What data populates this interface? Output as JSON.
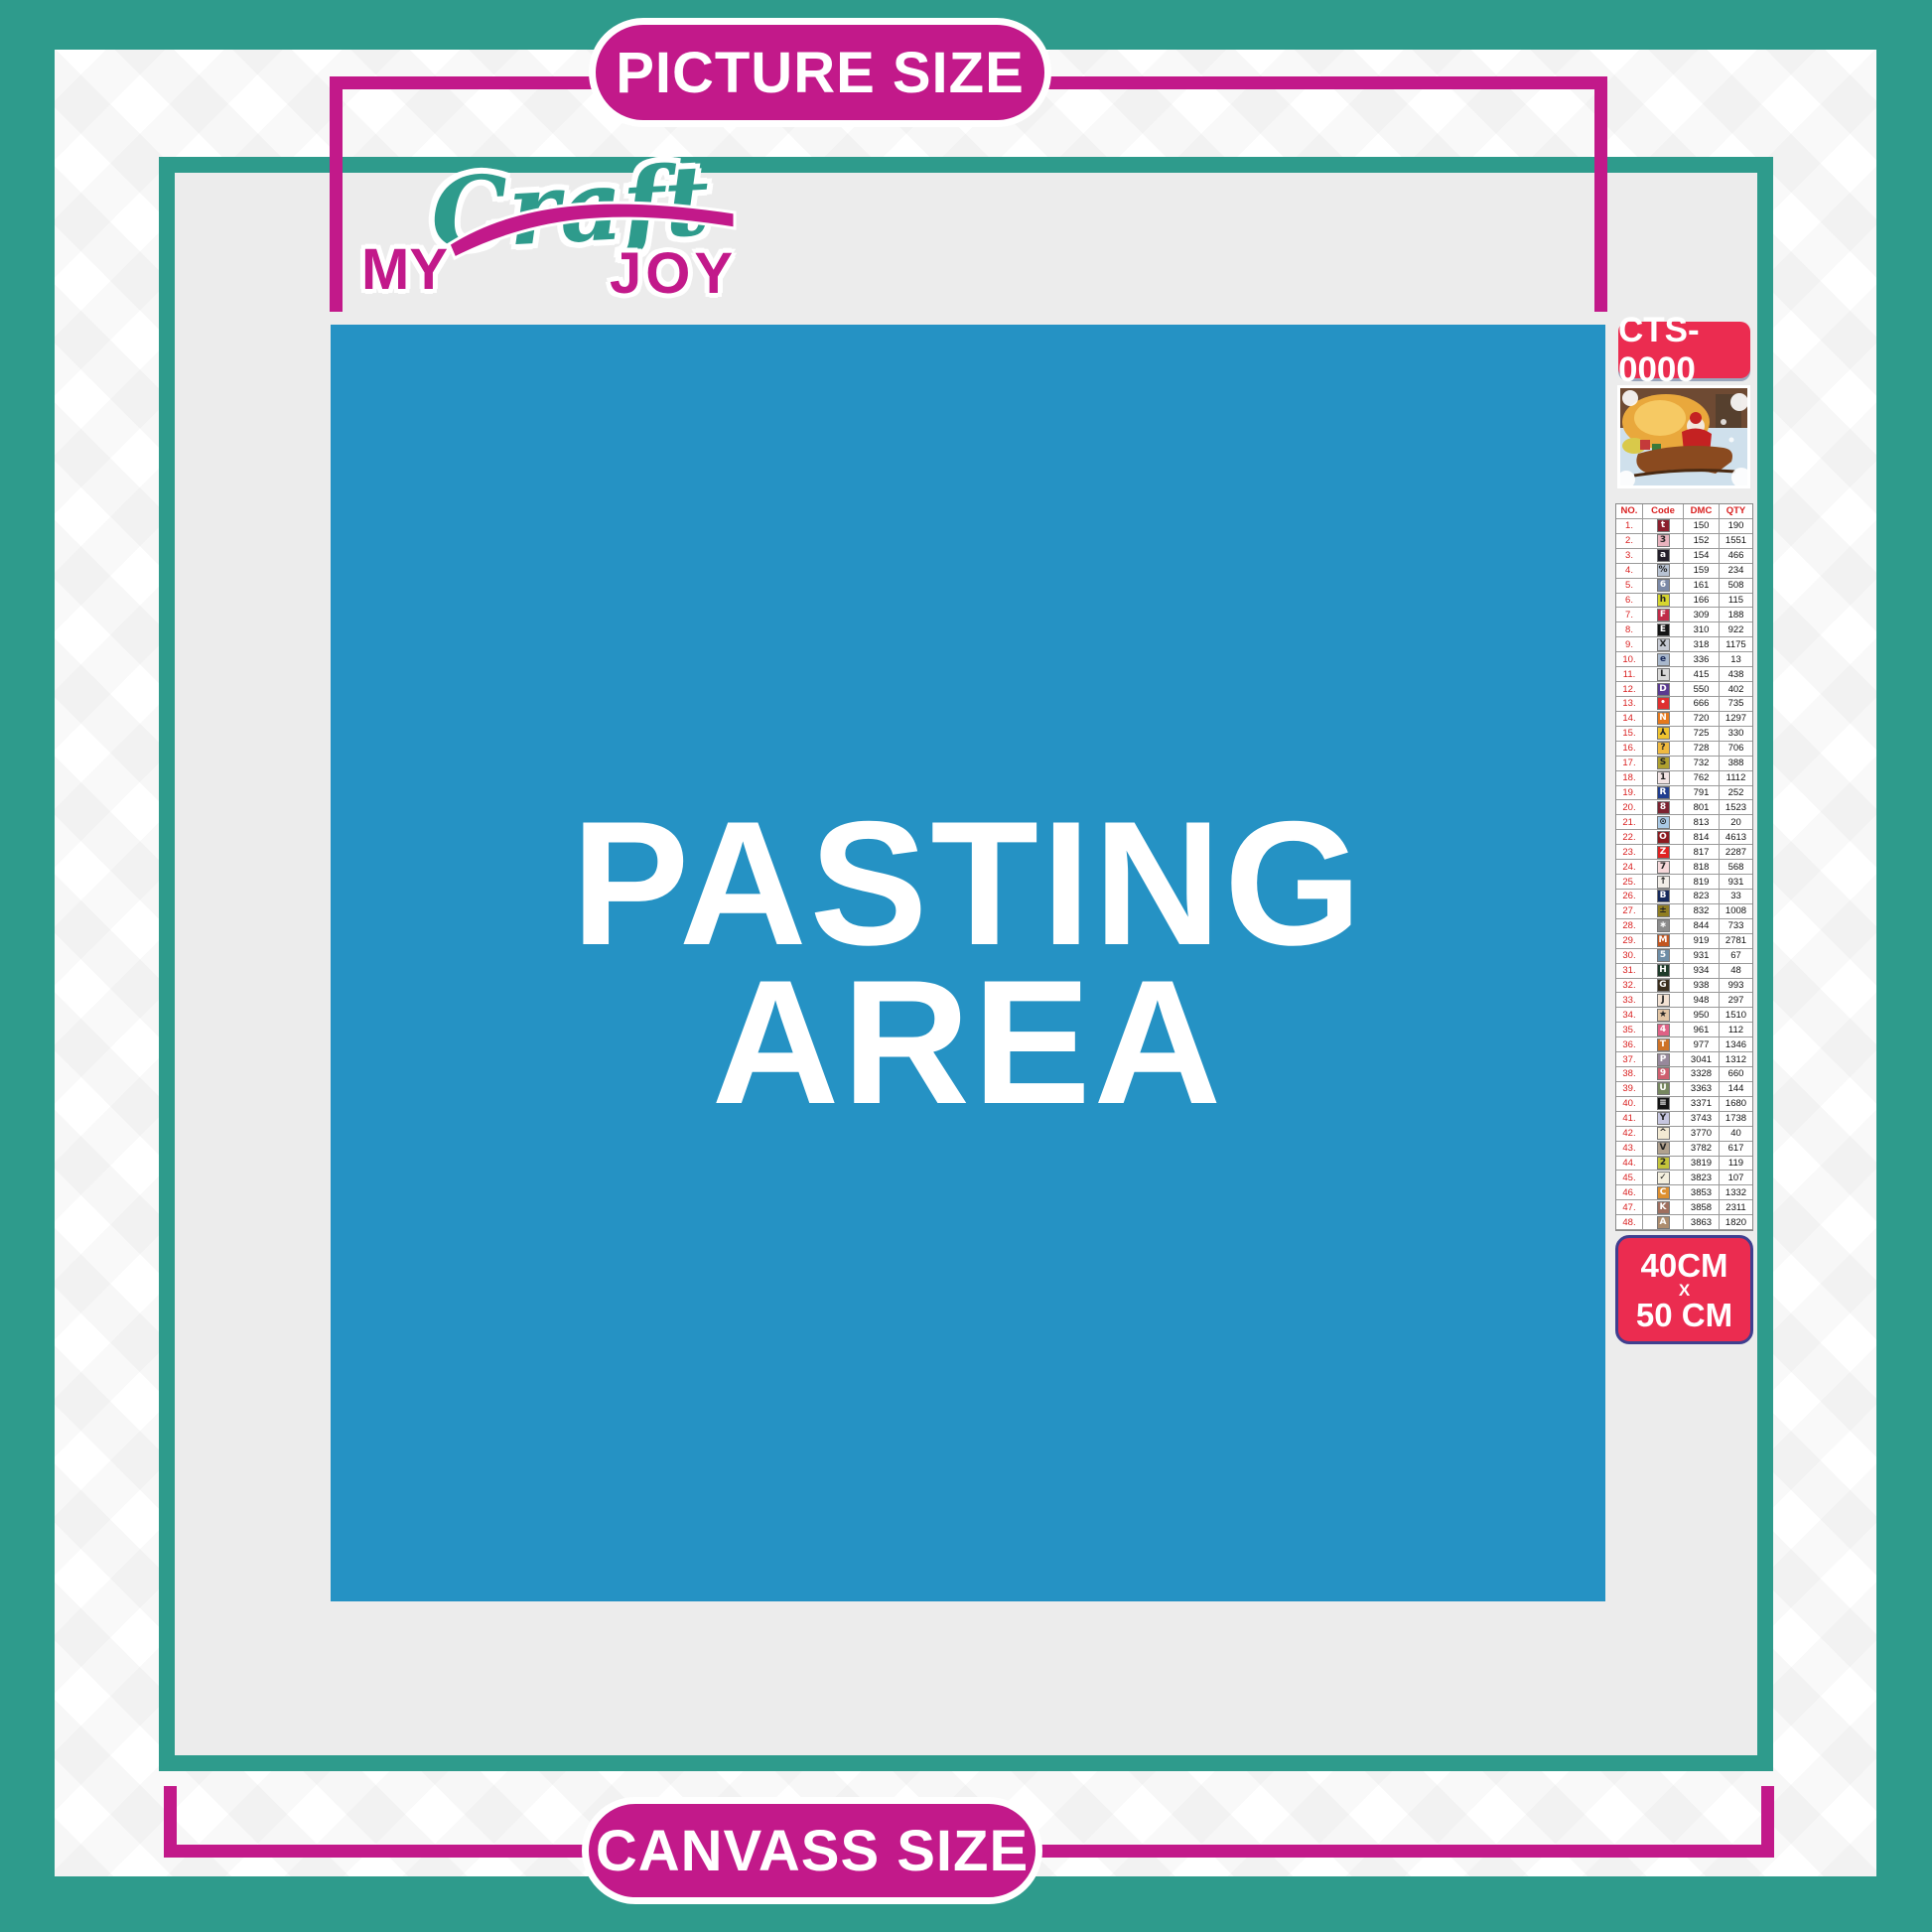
{
  "banners": {
    "top": "PICTURE SIZE",
    "bottom": "CANVASS SIZE"
  },
  "logo": {
    "part1": "MY",
    "part2": "Craft",
    "part3": "JOY"
  },
  "pasting_area": {
    "line1": "PASTING",
    "line2": "AREA"
  },
  "product": {
    "code": "CTS-0000",
    "size_line1": "40CM",
    "size_line2": "X",
    "size_line3": "50 CM",
    "preview": "santa-claus-sleigh-christmas-painting-thumbnail"
  },
  "colors": {
    "teal": "#2E9B8C",
    "magenta": "#C2198A",
    "blue_pasting": "#2592C4",
    "badge_red": "#EB2C50",
    "badge_border_blue": "#3F3F8F",
    "inner_gray": "#ECECEC",
    "table_red": "#D91F1F"
  },
  "color_chart": {
    "headers": [
      "NO.",
      "Code",
      "DMC",
      "QTY"
    ],
    "rows": [
      {
        "no": "1.",
        "symbol": "t",
        "symbol_bg": "#8B1E2D",
        "symbol_fg": "#FFFFFF",
        "dmc": "150",
        "qty": "190"
      },
      {
        "no": "2.",
        "symbol": "3",
        "symbol_bg": "#E9B3BE",
        "symbol_fg": "#222222",
        "dmc": "152",
        "qty": "1551"
      },
      {
        "no": "3.",
        "symbol": "a",
        "symbol_bg": "#241F2A",
        "symbol_fg": "#FFFFFF",
        "dmc": "154",
        "qty": "466"
      },
      {
        "no": "4.",
        "symbol": "%",
        "symbol_bg": "#B7C2D2",
        "symbol_fg": "#222222",
        "dmc": "159",
        "qty": "234"
      },
      {
        "no": "5.",
        "symbol": "6",
        "symbol_bg": "#7B89A6",
        "symbol_fg": "#FFFFFF",
        "dmc": "161",
        "qty": "508"
      },
      {
        "no": "6.",
        "symbol": "h",
        "symbol_bg": "#D6D52F",
        "symbol_fg": "#222222",
        "dmc": "166",
        "qty": "115"
      },
      {
        "no": "7.",
        "symbol": "F",
        "symbol_bg": "#C02A48",
        "symbol_fg": "#FFFFFF",
        "dmc": "309",
        "qty": "188"
      },
      {
        "no": "8.",
        "symbol": "E",
        "symbol_bg": "#141414",
        "symbol_fg": "#FFFFFF",
        "dmc": "310",
        "qty": "922"
      },
      {
        "no": "9.",
        "symbol": "X",
        "symbol_bg": "#C6CAD3",
        "symbol_fg": "#222222",
        "dmc": "318",
        "qty": "1175"
      },
      {
        "no": "10.",
        "symbol": "e",
        "symbol_bg": "#A9B8CC",
        "symbol_fg": "#1A2A5A",
        "dmc": "336",
        "qty": "13"
      },
      {
        "no": "11.",
        "symbol": "L",
        "symbol_bg": "#D8D8D8",
        "symbol_fg": "#222222",
        "dmc": "415",
        "qty": "438"
      },
      {
        "no": "12.",
        "symbol": "D",
        "symbol_bg": "#5A3A90",
        "symbol_fg": "#FFFFFF",
        "dmc": "550",
        "qty": "402"
      },
      {
        "no": "13.",
        "symbol": "•",
        "symbol_bg": "#DF2F2F",
        "symbol_fg": "#FFFFFF",
        "dmc": "666",
        "qty": "735"
      },
      {
        "no": "14.",
        "symbol": "N",
        "symbol_bg": "#E5791D",
        "symbol_fg": "#FFFFFF",
        "dmc": "720",
        "qty": "1297"
      },
      {
        "no": "15.",
        "symbol": "⅄",
        "symbol_bg": "#EFC32F",
        "symbol_fg": "#222222",
        "dmc": "725",
        "qty": "330"
      },
      {
        "no": "16.",
        "symbol": "?",
        "symbol_bg": "#EFB93F",
        "symbol_fg": "#222222",
        "dmc": "728",
        "qty": "706"
      },
      {
        "no": "17.",
        "symbol": "S",
        "symbol_bg": "#AFA02F",
        "symbol_fg": "#222222",
        "dmc": "732",
        "qty": "388"
      },
      {
        "no": "18.",
        "symbol": "1",
        "symbol_bg": "#F2E4E4",
        "symbol_fg": "#222222",
        "dmc": "762",
        "qty": "1112"
      },
      {
        "no": "19.",
        "symbol": "R",
        "symbol_bg": "#1F3D8F",
        "symbol_fg": "#FFFFFF",
        "dmc": "791",
        "qty": "252"
      },
      {
        "no": "20.",
        "symbol": "8",
        "symbol_bg": "#7C2230",
        "symbol_fg": "#FFFFFF",
        "dmc": "801",
        "qty": "1523"
      },
      {
        "no": "21.",
        "symbol": "⊙",
        "symbol_bg": "#A9C9E5",
        "symbol_fg": "#222222",
        "dmc": "813",
        "qty": "20"
      },
      {
        "no": "22.",
        "symbol": "O",
        "symbol_bg": "#8B1A1F",
        "symbol_fg": "#FFFFFF",
        "dmc": "814",
        "qty": "4613"
      },
      {
        "no": "23.",
        "symbol": "Z",
        "symbol_bg": "#DF2222",
        "symbol_fg": "#FFFFFF",
        "dmc": "817",
        "qty": "2287"
      },
      {
        "no": "24.",
        "symbol": "7",
        "symbol_bg": "#F6D8DA",
        "symbol_fg": "#222222",
        "dmc": "818",
        "qty": "568"
      },
      {
        "no": "25.",
        "symbol": "↑",
        "symbol_bg": "#F2EEE8",
        "symbol_fg": "#222222",
        "dmc": "819",
        "qty": "931"
      },
      {
        "no": "26.",
        "symbol": "B",
        "symbol_bg": "#172A5C",
        "symbol_fg": "#FFFFFF",
        "dmc": "823",
        "qty": "33"
      },
      {
        "no": "27.",
        "symbol": "±",
        "symbol_bg": "#8F7D22",
        "symbol_fg": "#222222",
        "dmc": "832",
        "qty": "1008"
      },
      {
        "no": "28.",
        "symbol": "∗",
        "symbol_bg": "#8C8C8C",
        "symbol_fg": "#FFFFFF",
        "dmc": "844",
        "qty": "733"
      },
      {
        "no": "29.",
        "symbol": "M",
        "symbol_bg": "#C2551F",
        "symbol_fg": "#FFFFFF",
        "dmc": "919",
        "qty": "2781"
      },
      {
        "no": "30.",
        "symbol": "5",
        "symbol_bg": "#6E8DA6",
        "symbol_fg": "#FFFFFF",
        "dmc": "931",
        "qty": "67"
      },
      {
        "no": "31.",
        "symbol": "H",
        "symbol_bg": "#1E3B2A",
        "symbol_fg": "#FFFFFF",
        "dmc": "934",
        "qty": "48"
      },
      {
        "no": "32.",
        "symbol": "G",
        "symbol_bg": "#3A2E1E",
        "symbol_fg": "#FFFFFF",
        "dmc": "938",
        "qty": "993"
      },
      {
        "no": "33.",
        "symbol": "J",
        "symbol_bg": "#F3E2D3",
        "symbol_fg": "#222222",
        "dmc": "948",
        "qty": "297"
      },
      {
        "no": "34.",
        "symbol": "★",
        "symbol_bg": "#E2C5A4",
        "symbol_fg": "#222222",
        "dmc": "950",
        "qty": "1510"
      },
      {
        "no": "35.",
        "symbol": "4",
        "symbol_bg": "#DE6185",
        "symbol_fg": "#FFFFFF",
        "dmc": "961",
        "qty": "112"
      },
      {
        "no": "36.",
        "symbol": "T",
        "symbol_bg": "#CE7227",
        "symbol_fg": "#FFFFFF",
        "dmc": "977",
        "qty": "1346"
      },
      {
        "no": "37.",
        "symbol": "P",
        "symbol_bg": "#97889B",
        "symbol_fg": "#FFFFFF",
        "dmc": "3041",
        "qty": "1312"
      },
      {
        "no": "38.",
        "symbol": "9",
        "symbol_bg": "#CE5F6F",
        "symbol_fg": "#FFFFFF",
        "dmc": "3328",
        "qty": "660"
      },
      {
        "no": "39.",
        "symbol": "U",
        "symbol_bg": "#76875F",
        "symbol_fg": "#FFFFFF",
        "dmc": "3363",
        "qty": "144"
      },
      {
        "no": "40.",
        "symbol": "≡",
        "symbol_bg": "#141414",
        "symbol_fg": "#FFFFFF",
        "dmc": "3371",
        "qty": "1680"
      },
      {
        "no": "41.",
        "symbol": "Y",
        "symbol_bg": "#C6C6DF",
        "symbol_fg": "#222222",
        "dmc": "3743",
        "qty": "1738"
      },
      {
        "no": "42.",
        "symbol": "^",
        "symbol_bg": "#F3EAD3",
        "symbol_fg": "#222222",
        "dmc": "3770",
        "qty": "40"
      },
      {
        "no": "43.",
        "symbol": "V",
        "symbol_bg": "#B0A18E",
        "symbol_fg": "#222222",
        "dmc": "3782",
        "qty": "617"
      },
      {
        "no": "44.",
        "symbol": "2",
        "symbol_bg": "#C4C43B",
        "symbol_fg": "#222222",
        "dmc": "3819",
        "qty": "119"
      },
      {
        "no": "45.",
        "symbol": "✓",
        "symbol_bg": "#F4EFDE",
        "symbol_fg": "#222222",
        "dmc": "3823",
        "qty": "107"
      },
      {
        "no": "46.",
        "symbol": "C",
        "symbol_bg": "#DE9030",
        "symbol_fg": "#FFFFFF",
        "dmc": "3853",
        "qty": "1332"
      },
      {
        "no": "47.",
        "symbol": "K",
        "symbol_bg": "#9F6F5F",
        "symbol_fg": "#FFFFFF",
        "dmc": "3858",
        "qty": "2311"
      },
      {
        "no": "48.",
        "symbol": "A",
        "symbol_bg": "#AD8D6E",
        "symbol_fg": "#FFFFFF",
        "dmc": "3863",
        "qty": "1820"
      }
    ]
  }
}
